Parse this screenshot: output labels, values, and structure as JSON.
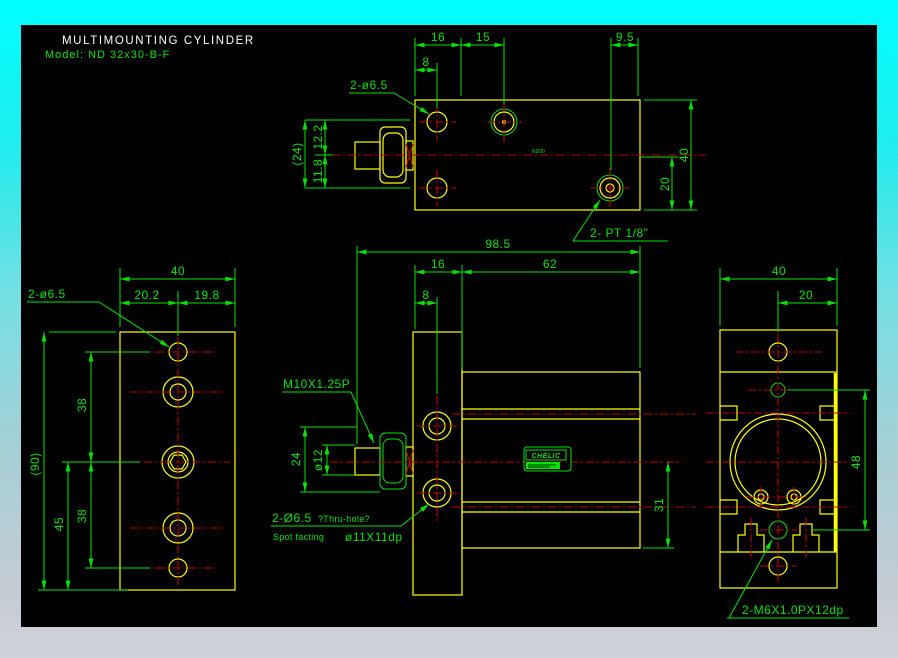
{
  "title": {
    "line1": "MULTIMOUNTING  CYLINDER",
    "line2": "Model:  ND 32x30-B-F"
  },
  "colors": {
    "background": "#000000",
    "outline": "#ffff00",
    "dimension": "#00e400",
    "centerline": "#c40000",
    "title_text": "#ffffff",
    "border_top": "#00ffff",
    "border_bottom": "#cfd2d8"
  },
  "views": {
    "top": {
      "dims": {
        "w16": "16",
        "w15": "15",
        "w9_5": "9.5",
        "w8": "8",
        "h40": "40",
        "h20": "20",
        "h24": "(24)",
        "h12_2": "12.2",
        "h11_8": "11.8"
      },
      "labels": {
        "holes": "2-ø6.5",
        "port": "2- PT 1/8\"",
        "marking": "ND30"
      }
    },
    "front": {
      "dims": {
        "w98_5": "98.5",
        "w16": "16",
        "w62": "62",
        "w8": "8",
        "h24": "24",
        "dia12": "ø12",
        "h31": "31"
      },
      "labels": {
        "thread": "M10X1.25P",
        "hole_callout": "2-Ø6.5",
        "hole_note": "?Thru-hole?",
        "spotface_prefix": "Spot facting",
        "spotface_size": "ø11X11dp",
        "nameplate": "CHELIC"
      }
    },
    "side": {
      "dims": {
        "w40": "40",
        "w20_2": "20.2",
        "w19_8": "19.8",
        "h90": "(90)",
        "h45": "45",
        "h38_upper": "38",
        "h38_lower": "38"
      },
      "labels": {
        "holes": "2-ø6.5"
      }
    },
    "end": {
      "dims": {
        "w40": "40",
        "w20": "20",
        "h48": "48"
      },
      "labels": {
        "thread": "2-M6X1.0PX12dp"
      }
    }
  }
}
